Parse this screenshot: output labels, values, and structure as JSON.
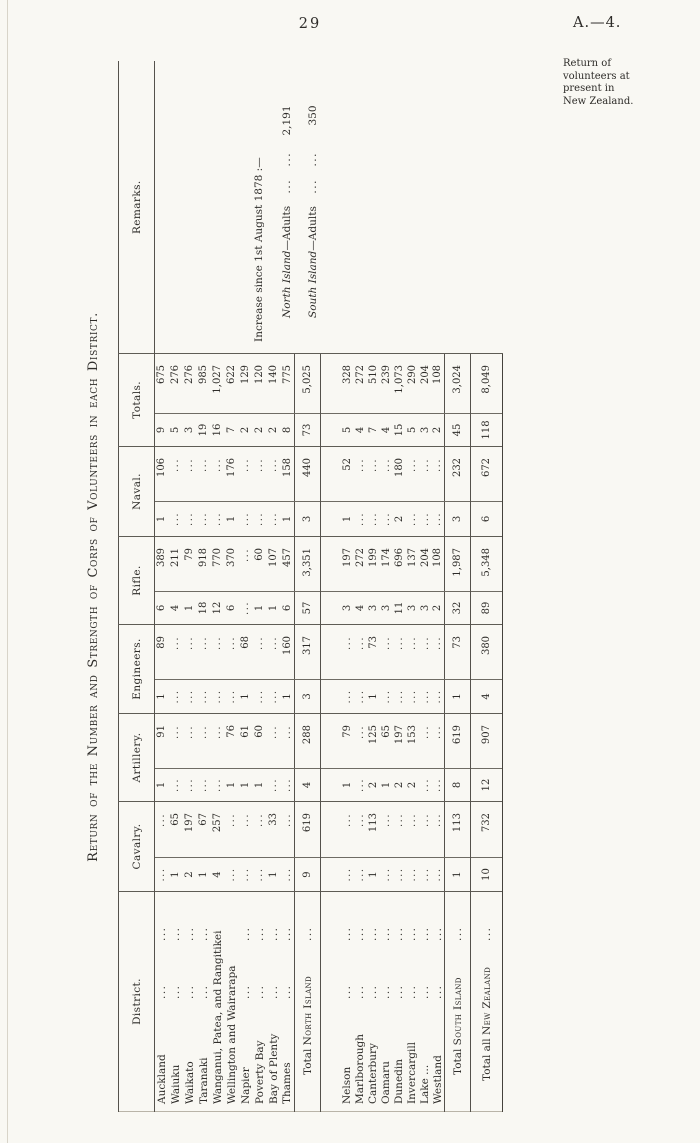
{
  "colors": {
    "paper": "#f9f8f3",
    "ink": "#2e2c29",
    "rule": "#55524c"
  },
  "page": {
    "number": "29",
    "doc_ref": "A.—4.",
    "sidenote": "Return of\nvolunteers at\npresent in\nNew Zealand."
  },
  "table": {
    "title": "Return of the Number and Strength of Corps of Volunteers in each District.",
    "col_headers": {
      "district": "District.",
      "cavalry": "Cavalry.",
      "artillery": "Artillery.",
      "engineers": "Engineers.",
      "rifle": "Rifle.",
      "naval": "Naval.",
      "totals": "Totals.",
      "remarks": "Remarks."
    },
    "empty_mark": "...",
    "rows": [
      {
        "type": "district",
        "section": "north",
        "name": "Auckland",
        "leaders": 2,
        "cells": [
          "...",
          "...",
          "1",
          "91",
          "1",
          "89",
          "6",
          "389",
          "1",
          "106",
          "9",
          "675"
        ]
      },
      {
        "type": "district",
        "section": "north",
        "name": "Waiuku",
        "leaders": 2,
        "cells": [
          "1",
          "65",
          "...",
          "...",
          "...",
          "...",
          "4",
          "211",
          "...",
          "...",
          "5",
          "276"
        ]
      },
      {
        "type": "district",
        "section": "north",
        "name": "Waikato",
        "leaders": 2,
        "cells": [
          "2",
          "197",
          "...",
          "...",
          "...",
          "...",
          "1",
          "79",
          "...",
          "...",
          "3",
          "276"
        ]
      },
      {
        "type": "district",
        "section": "north",
        "name": "Taranaki",
        "leaders": 2,
        "cells": [
          "1",
          "67",
          "...",
          "...",
          "...",
          "...",
          "18",
          "918",
          "...",
          "...",
          "19",
          "985"
        ]
      },
      {
        "type": "district",
        "section": "north",
        "name": "Wanganui, Patea, and Rangitikei",
        "leaders": 0,
        "cells": [
          "4",
          "257",
          "...",
          "...",
          "...",
          "...",
          "12",
          "770",
          "...",
          "...",
          "16",
          "1,027"
        ]
      },
      {
        "type": "district",
        "section": "north",
        "name": "Wellington and Wairarapa",
        "leaders": 0,
        "cells": [
          "...",
          "...",
          "1",
          "76",
          "...",
          "...",
          "6",
          "370",
          "1",
          "176",
          "7",
          "622"
        ]
      },
      {
        "type": "district",
        "section": "north",
        "name": "Napier",
        "leaders": 2,
        "cells": [
          "...",
          "...",
          "1",
          "61",
          "1",
          "68",
          "...",
          "...",
          "...",
          "...",
          "2",
          "129"
        ]
      },
      {
        "type": "district",
        "section": "north",
        "name": "Poverty Bay",
        "leaders": 2,
        "cells": [
          "...",
          "...",
          "1",
          "60",
          "...",
          "...",
          "1",
          "60",
          "...",
          "...",
          "2",
          "120"
        ]
      },
      {
        "type": "district",
        "section": "north",
        "name": "Bay of Plenty",
        "leaders": 2,
        "cells": [
          "1",
          "33",
          "...",
          "...",
          "...",
          "...",
          "1",
          "107",
          "...",
          "...",
          "2",
          "140"
        ]
      },
      {
        "type": "district",
        "section": "north",
        "name": "Thames",
        "leaders": 2,
        "cells": [
          "...",
          "...",
          "...",
          "...",
          "1",
          "160",
          "6",
          "457",
          "1",
          "158",
          "8",
          "775"
        ]
      },
      {
        "type": "total",
        "prefix": "Total ",
        "sc": "North Island",
        "leaders": 1,
        "cells": [
          "9",
          "619",
          "4",
          "288",
          "3",
          "317",
          "57",
          "3,351",
          "3",
          "440",
          "73",
          "5,025"
        ]
      },
      {
        "type": "gap",
        "cells": [
          "",
          "",
          "",
          "",
          "",
          "",
          "",
          "",
          "",
          "",
          "",
          ""
        ]
      },
      {
        "type": "district",
        "section": "south",
        "name": "Nelson",
        "leaders": 2,
        "cells": [
          "...",
          "...",
          "1",
          "79",
          "...",
          "...",
          "3",
          "197",
          "1",
          "52",
          "5",
          "328"
        ]
      },
      {
        "type": "district",
        "section": "south",
        "name": "Marlborough",
        "leaders": 2,
        "cells": [
          "...",
          "...",
          "...",
          "...",
          "...",
          "...",
          "4",
          "272",
          "...",
          "...",
          "4",
          "272"
        ]
      },
      {
        "type": "district",
        "section": "south",
        "name": "Canterbury",
        "leaders": 2,
        "cells": [
          "1",
          "113",
          "2",
          "125",
          "1",
          "73",
          "3",
          "199",
          "...",
          "...",
          "7",
          "510"
        ]
      },
      {
        "type": "district",
        "section": "south",
        "name": "Oamaru",
        "leaders": 2,
        "cells": [
          "...",
          "...",
          "1",
          "65",
          "...",
          "...",
          "3",
          "174",
          "...",
          "...",
          "4",
          "239"
        ]
      },
      {
        "type": "district",
        "section": "south",
        "name": "Dunedin",
        "leaders": 2,
        "cells": [
          "...",
          "...",
          "2",
          "197",
          "...",
          "...",
          "11",
          "696",
          "2",
          "180",
          "15",
          "1,073"
        ]
      },
      {
        "type": "district",
        "section": "south",
        "name": "Invercargill",
        "leaders": 2,
        "cells": [
          "...",
          "...",
          "2",
          "153",
          "...",
          "...",
          "3",
          "137",
          "...",
          "...",
          "5",
          "290"
        ]
      },
      {
        "type": "district",
        "section": "south",
        "name": "Lake ...",
        "leaders": 2,
        "cells": [
          "...",
          "...",
          "...",
          "...",
          "...",
          "...",
          "3",
          "204",
          "...",
          "...",
          "3",
          "204"
        ]
      },
      {
        "type": "district",
        "section": "south",
        "name": "Westland",
        "leaders": 2,
        "cells": [
          "...",
          "...",
          "...",
          "...",
          "...",
          "...",
          "2",
          "108",
          "...",
          "...",
          "2",
          "108"
        ]
      },
      {
        "type": "total",
        "prefix": "Total ",
        "sc": "South Island",
        "leaders": 1,
        "cells": [
          "1",
          "113",
          "8",
          "619",
          "1",
          "73",
          "32",
          "1,987",
          "3",
          "232",
          "45",
          "3,024"
        ]
      },
      {
        "type": "grand",
        "prefix": "Total all ",
        "sc": "New Zealand",
        "leaders": 1,
        "cells": [
          "10",
          "732",
          "12",
          "907",
          "4",
          "380",
          "89",
          "5,348",
          "6",
          "672",
          "118",
          "8,049"
        ]
      }
    ],
    "remarks": {
      "heading": "Increase since 1st August 1878 :—",
      "lines": [
        {
          "island": "North Island",
          "rest": "—Adults",
          "value": "2,191"
        },
        {
          "island": "South Island",
          "rest": "—Adults",
          "value": "350"
        }
      ]
    }
  }
}
